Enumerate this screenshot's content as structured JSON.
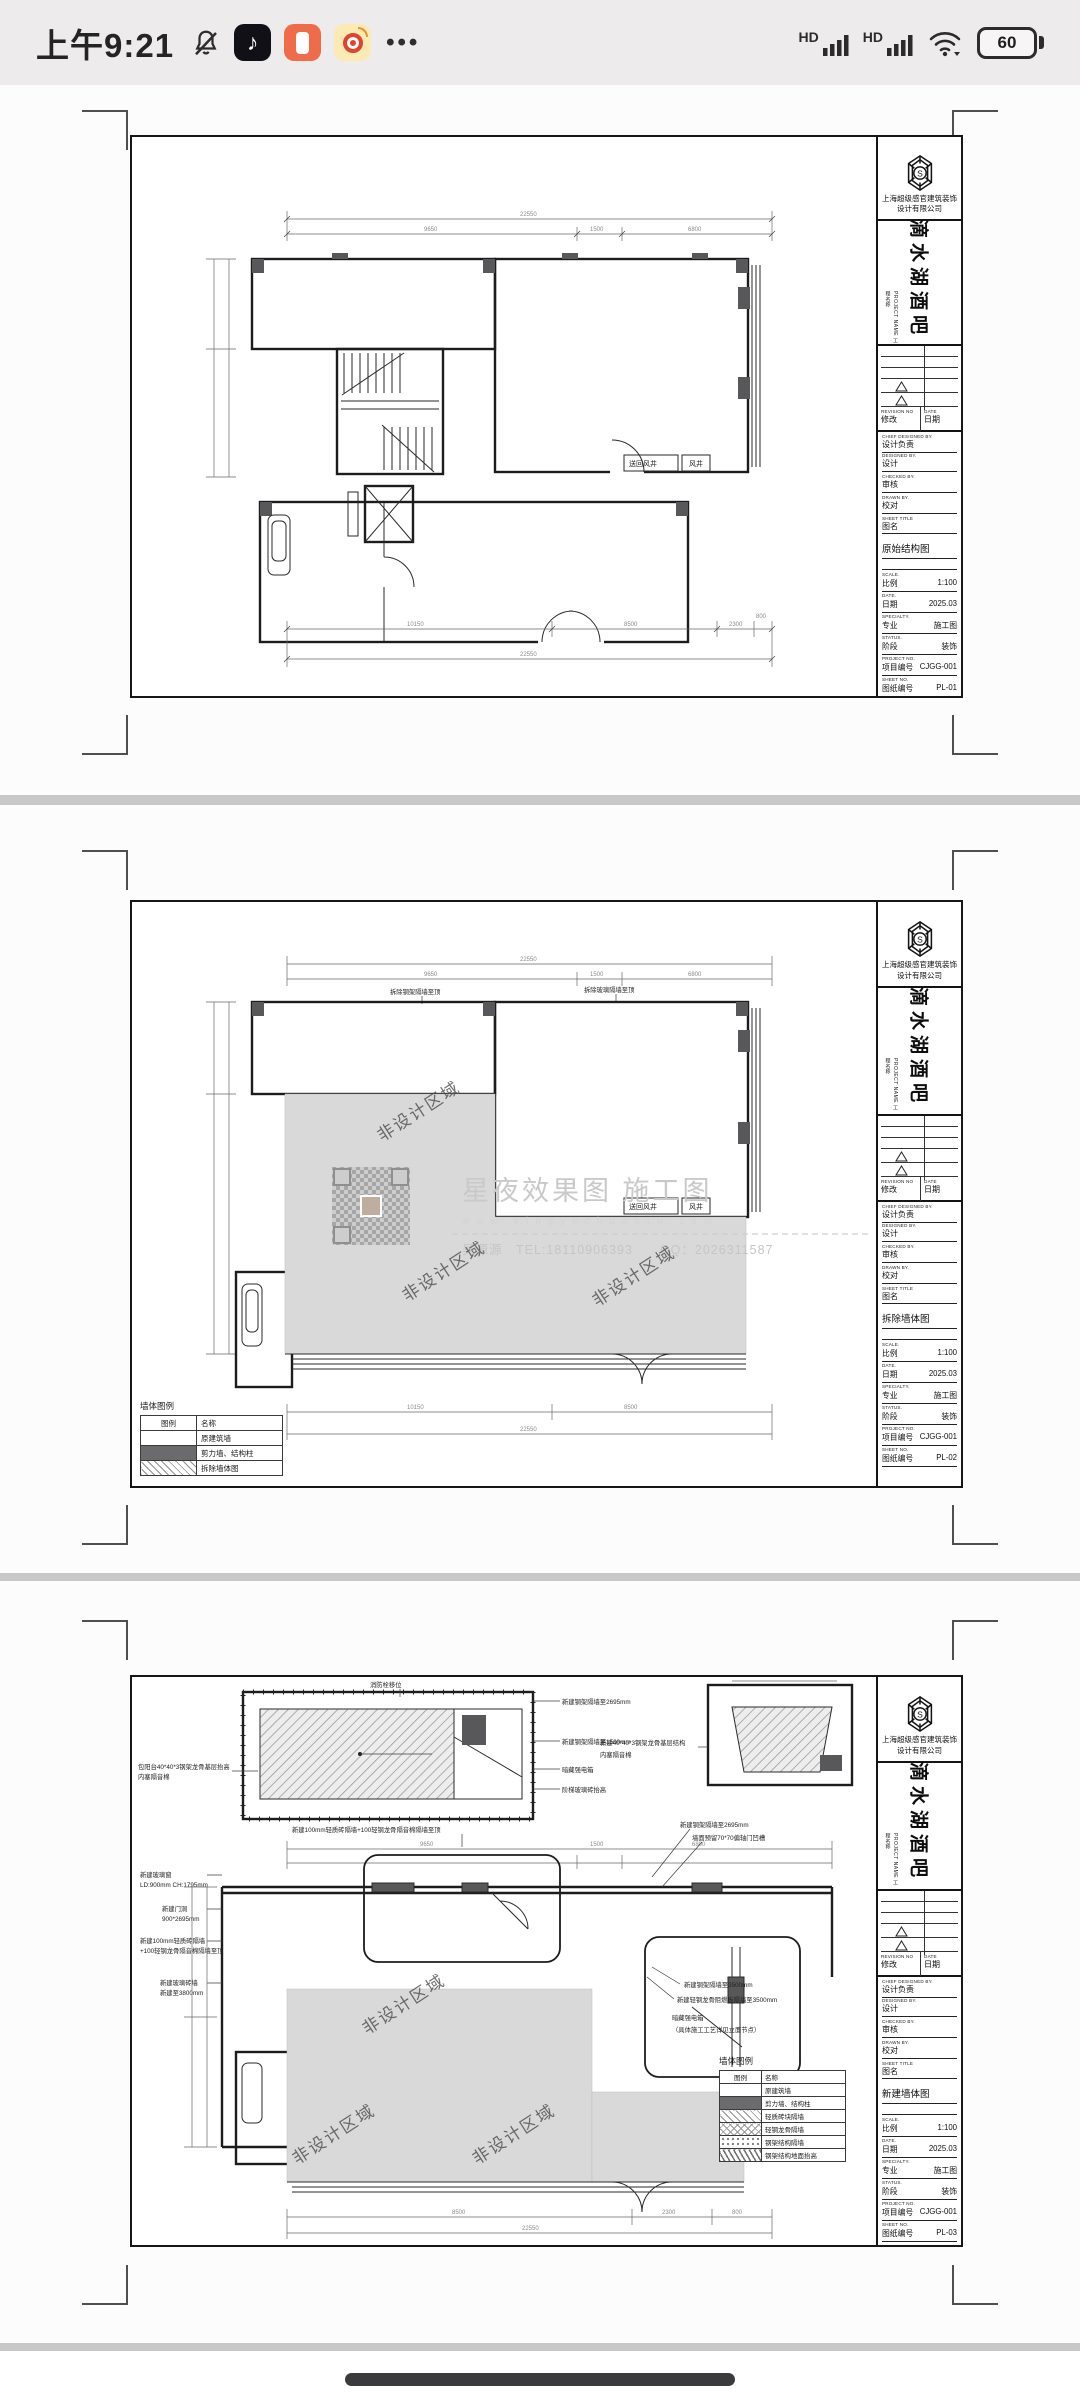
{
  "status_bar": {
    "time": "上午9:21",
    "more": "•••",
    "hd1": "HD",
    "hd2": "HD",
    "battery_percent": "60"
  },
  "company": {
    "line1": "上海超级感官建筑装饰",
    "line2": "设计有限公司"
  },
  "project": {
    "name": "滴水湖酒吧"
  },
  "tb": {
    "project_name_en": "PROJECT NAME",
    "project_name_cn": "工程名称",
    "revision_en": "REVISION NO",
    "revision_cn": "修改",
    "date_col_en": "DATE",
    "date_col_cn": "日期",
    "chief_en": "CHIEF DESIGNED BY.",
    "chief_cn": "设计负责",
    "designed_en": "DESIGNED BY.",
    "designed_cn": "设计",
    "checked_en": "CHECKED BY.",
    "checked_cn": "审核",
    "drawn_en": "DRAWN BY.",
    "drawn_cn": "校对",
    "sheet_title_en": "SHEET TITLE",
    "sheet_title_cn": "图名",
    "scale_en": "SCALE.",
    "scale_cn": "比例",
    "date_en": "DATE.",
    "date_cn": "日期",
    "specialty_en": "SPECIALTY.",
    "specialty_cn": "专业",
    "status_en": "STATUS.",
    "status_cn": "阶段",
    "project_no_en": "PROJECT NO.",
    "project_no_cn": "项目编号",
    "sheet_no_en": "SHEET NO.",
    "sheet_no_cn": "图纸编号"
  },
  "tbv": {
    "scale": "1:100",
    "date": "2025.03",
    "specialty": "施工图",
    "status": "装饰",
    "project_no": "CJGG-001"
  },
  "dims": {
    "total": "22550",
    "seg1": "9650",
    "seg2": "1500",
    "seg3": "6800",
    "b1": "10150",
    "b2": "8500",
    "b3": "2300",
    "b4": "800"
  },
  "watermark": {
    "brand": "星夜效果图 施工图",
    "url": "www.xingyechuantu.com",
    "contact": "吴源源　TEL:18110906393　　QQ：2026311587",
    "non_design_area": "非设计区域"
  },
  "vents": {
    "supply": "送回风井",
    "shaft": "风井"
  },
  "pages": [
    {
      "sheet_title": "原始结构图",
      "sheet_no": "PL-01"
    },
    {
      "sheet_title": "拆除墙体图",
      "sheet_no": "PL-02",
      "notes": {
        "n1": "拆除钢架隔墙至顶",
        "n2": "拆除玻璃隔墙至顶"
      },
      "legend": {
        "title": "墙体图例",
        "col_symbol": "图例",
        "col_name": "名称",
        "rows": [
          "原建筑墙",
          "剪力墙、结构柱",
          "拆除墙体图"
        ]
      }
    },
    {
      "sheet_title": "新建墙体图",
      "sheet_no": "PL-03",
      "notes": {
        "fire": "消防栓移位",
        "steel2695": "新建钢架隔墙至2695mm",
        "steel1500": "新建钢架隔墙至1500mm",
        "hidden_power": "暗藏强电箱",
        "glass_raise": "阶梯玻璃砖抬高",
        "balcony1": "包阳台40*40*3钢架龙骨基层抬高",
        "balcony2": "内塞隔音棉",
        "frame1": "新建40*40*3钢架龙骨基层结构",
        "frame2": "内塞隔音棉",
        "brick_top": "新建100mm轻质砖隔墙+100轻钢龙骨隔音棉隔墙至顶",
        "glass_win1": "新建玻璃窗",
        "glass_win2": "LD:900mm CH:1795mm",
        "door1": "新建门洞",
        "door2": "900*2695mm",
        "brick1": "新建100mm轻质砖隔墙",
        "brick2": "+100轻钢龙骨隔音棉隔墙至顶",
        "glassbrick1": "新建玻璃砖墙",
        "glassbrick2": "新建至3800mm",
        "groove": "墙面预留70*70偏轴门凹槽",
        "steel3500": "新建钢架隔墙至3500mm",
        "flame3500": "新建轻钢龙骨阻燃板隔墙至3500mm",
        "hidden_power2": "暗藏强电箱",
        "hidden_power2b": "（具体施工工艺详见立面节点）",
        "weak_box": "暗藏弱电箱"
      },
      "legend": {
        "title": "墙体图例",
        "col_symbol": "图例",
        "col_name": "名称",
        "rows": [
          "原建筑墙",
          "剪力墙、结构柱",
          "轻质砖块隔墙",
          "轻钢龙骨隔墙",
          "钢架结构隔墙",
          "钢架结构地面抬高"
        ]
      }
    }
  ]
}
